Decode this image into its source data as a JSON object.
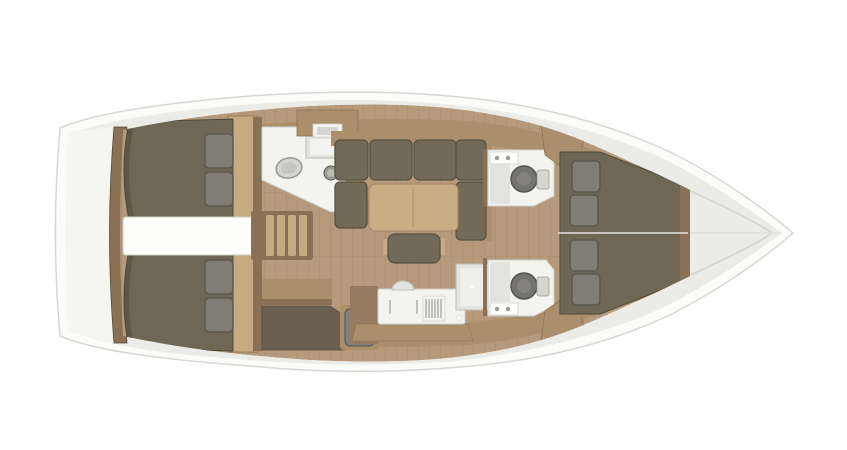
{
  "meta": {
    "view": "sailboat-interior-layout-top-view",
    "orientation": "bow-right-stern-left"
  },
  "areas": [
    "hull",
    "stern-platform",
    "transom",
    "aft-cabin-port",
    "aft-cabin-starboard",
    "engine-compartment",
    "companionway-steps",
    "salon-head",
    "salon-sofa",
    "salon-table",
    "salon-bench",
    "galley",
    "nav-station",
    "mid-head-port",
    "mid-head-starboard",
    "shower-tray",
    "forward-cabin",
    "bow"
  ],
  "colors": {
    "background": "#ffffff",
    "hull_white": "#fbfbf9",
    "hull_outline": "#d7d7d2",
    "deck_gray": "#ebebe8",
    "transom_white": "#f5f5f2",
    "floor_tan": "#b69a7b",
    "plank_line": "#8a715a",
    "cabinet_tan": "#ab8e6c",
    "cabinet_mid": "#977b5e",
    "cabinet_light": "#c6aa81",
    "cabinet_dark": "#8a7054",
    "nav_dark": "#6b5f4e",
    "table_tan": "#c9ad84",
    "table_edge": "#a18565",
    "bed_olive": "#6e6755",
    "bed_shadow": "#4e4839",
    "sofa_olive": "#716a59",
    "cushion_edge": "#57513f",
    "pillow_gray": "#7f7d74",
    "pillow_edge": "#5a584f",
    "white_fixture": "#f3f3f0",
    "white_box": "#fdfdfc",
    "fixture_outline": "#cfcfca",
    "gray_fixture": "#d6d6d1",
    "metal_gray": "#9a9a94",
    "sink_inner": "#b9b9b4",
    "toilet_gray": "#74746d",
    "toilet_ring": "#55554f",
    "toilet_inner": "#c6c6c1",
    "toilet_inner_dark": "#83837c",
    "shower_gray": "#e3e3df",
    "shower_edge": "#bdbdb7",
    "stove_dark": "#8e8e88",
    "seat_gray": "#82807a",
    "seat_edge": "#5f5d55",
    "hatch_olive": "#7e7560",
    "hatch_edge": "#d8c49c",
    "seam_white": "#f1f0ec",
    "bow_seam": "#d2d2cd",
    "faucet_gray": "#c0c0ba"
  }
}
